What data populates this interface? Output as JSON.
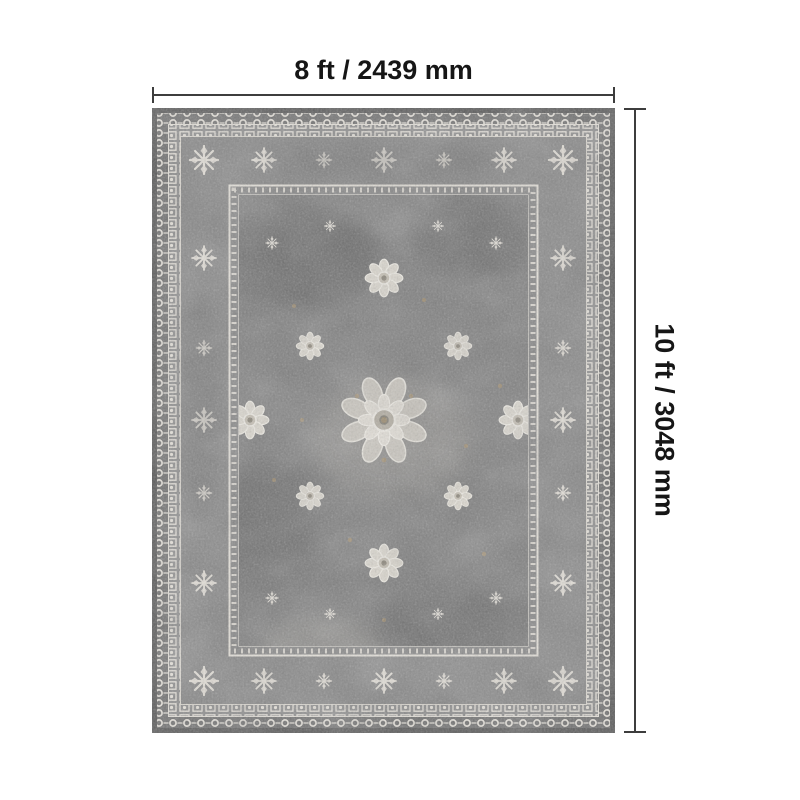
{
  "diagram": {
    "kind": "product-size-diagram",
    "subject": "vintage-distressed-gray-oriental-area-rug",
    "width_label": "8 ft / 2439 mm",
    "height_label": "10 ft / 3048 mm"
  },
  "colors": {
    "background": "#ffffff",
    "dimension_line": "#3d3d3d",
    "label_text": "#161616",
    "rug_edge_dark": "#565656",
    "rug_border_field": "#868686",
    "rug_main_field": "#7e7e7e",
    "rug_motif_light": "#e7e3db",
    "rug_accent_tan": "#b09468"
  }
}
